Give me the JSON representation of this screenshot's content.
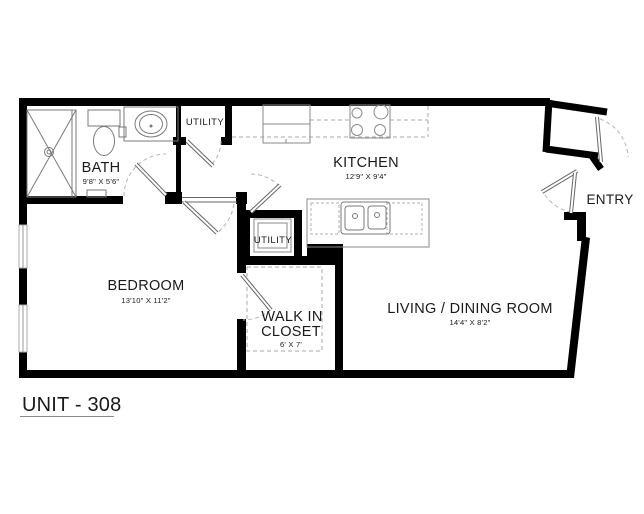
{
  "title": "UNIT - 308",
  "rooms": {
    "bath": {
      "label": "BATH",
      "dims": "9'8\" X 5'6\""
    },
    "utility_hall": {
      "label": "UTILITY"
    },
    "kitchen": {
      "label": "KITCHEN",
      "dims": "12'9\" X 9'4\""
    },
    "utility_closet": {
      "label": "UTILITY"
    },
    "bedroom": {
      "label": "BEDROOM",
      "dims": "13'10\" X 11'2\""
    },
    "walk_in_closet": {
      "label_line1": "WALK IN",
      "label_line2": "CLOSET",
      "dims": "6' X 7'"
    },
    "living_dining": {
      "label": "LIVING / DINING ROOM",
      "dims": "14'4\" X 8'2\""
    },
    "entry": {
      "label": "ENTRY"
    }
  },
  "colors": {
    "wall": "#000000",
    "text": "#1a1a1a",
    "fixture_line": "#7a7a7a",
    "dashed_line": "#a9a9a9",
    "background": "#ffffff"
  }
}
